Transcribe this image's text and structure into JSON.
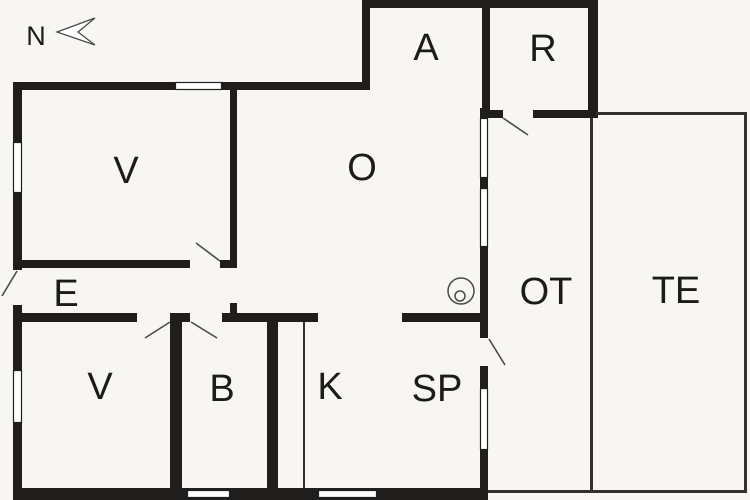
{
  "plan": {
    "width": 750,
    "height": 500,
    "background": "#f7f6f3",
    "wall_color": "#1f1e1c",
    "thin_wall_color": "#33322f",
    "door_leaf_color": "#4b4a47",
    "window_fill": "#ffffff",
    "window_stroke": "#1f1e1c",
    "label_color": "#1c1b19",
    "walls": [
      [
        13,
        82,
        9,
        60
      ],
      [
        13,
        193,
        9,
        77
      ],
      [
        13,
        305,
        9,
        65
      ],
      [
        13,
        423,
        9,
        77
      ],
      [
        13,
        82,
        162,
        8
      ],
      [
        222,
        82,
        148,
        8
      ],
      [
        362,
        0,
        8,
        90
      ],
      [
        362,
        0,
        236,
        8
      ],
      [
        588,
        0,
        10,
        118
      ],
      [
        482,
        8,
        8,
        102
      ],
      [
        482,
        110,
        21,
        8
      ],
      [
        533,
        110,
        65,
        8
      ],
      [
        230,
        90,
        7,
        178
      ],
      [
        22,
        260,
        168,
        8
      ],
      [
        220,
        260,
        17,
        8
      ],
      [
        22,
        313,
        115,
        9
      ],
      [
        170,
        313,
        20,
        9
      ],
      [
        222,
        313,
        96,
        9
      ],
      [
        230,
        303,
        7,
        10
      ],
      [
        402,
        313,
        86,
        9
      ],
      [
        170,
        322,
        12,
        166
      ],
      [
        267,
        322,
        11,
        166
      ],
      [
        13,
        488,
        475,
        12
      ],
      [
        480,
        108,
        8,
        10
      ],
      [
        480,
        178,
        8,
        10
      ],
      [
        480,
        247,
        8,
        91
      ],
      [
        480,
        366,
        8,
        22
      ],
      [
        480,
        450,
        8,
        50
      ]
    ],
    "thin_walls": [
      [
        590,
        118,
        3,
        375
      ],
      [
        596,
        112,
        150,
        3
      ],
      [
        744,
        112,
        3,
        381
      ],
      [
        593,
        490,
        153,
        3
      ],
      [
        488,
        490,
        102,
        3
      ],
      [
        303,
        322,
        2,
        166
      ]
    ],
    "windows": [
      [
        13,
        142,
        9,
        51
      ],
      [
        13,
        370,
        9,
        53
      ],
      [
        175,
        82,
        47,
        8
      ],
      [
        187,
        490,
        43,
        8
      ],
      [
        318,
        490,
        59,
        8
      ],
      [
        480,
        118,
        8,
        60
      ],
      [
        480,
        188,
        8,
        59
      ],
      [
        480,
        388,
        8,
        62
      ]
    ],
    "door_leaves": [
      {
        "name": "entrance-door-leaf",
        "x1": 17,
        "y1": 271,
        "x2": 2,
        "y2": 296
      },
      {
        "name": "door-leaf-v-upper",
        "x1": 220,
        "y1": 261,
        "x2": 196,
        "y2": 243
      },
      {
        "name": "door-leaf-v-lower",
        "x1": 170,
        "y1": 322,
        "x2": 145,
        "y2": 338
      },
      {
        "name": "door-leaf-b",
        "x1": 191,
        "y1": 322,
        "x2": 217,
        "y2": 338
      },
      {
        "name": "door-leaf-r",
        "x1": 503,
        "y1": 118,
        "x2": 528,
        "y2": 135
      },
      {
        "name": "door-leaf-sp-ot",
        "x1": 489,
        "y1": 339,
        "x2": 505,
        "y2": 365
      }
    ],
    "stove_symbol": {
      "cx": 461,
      "cy": 291,
      "r": 13,
      "inner_cx": 460,
      "inner_cy": 296,
      "inner_r": 5
    },
    "north": {
      "label": "N",
      "label_x": 36,
      "label_y": 45,
      "arrow_points": "57,32 95,18 78,32 95,45"
    }
  },
  "rooms": [
    {
      "id": "room-label-a",
      "name": "A",
      "x": 426,
      "y": 60
    },
    {
      "id": "room-label-r",
      "name": "R",
      "x": 543,
      "y": 61
    },
    {
      "id": "room-label-v-upper",
      "name": "V",
      "x": 126,
      "y": 183
    },
    {
      "id": "room-label-o",
      "name": "O",
      "x": 362,
      "y": 180
    },
    {
      "id": "room-label-e",
      "name": "E",
      "x": 66,
      "y": 306
    },
    {
      "id": "room-label-ot",
      "name": "OT",
      "x": 546,
      "y": 304
    },
    {
      "id": "room-label-te",
      "name": "TE",
      "x": 676,
      "y": 303
    },
    {
      "id": "room-label-v-lower",
      "name": "V",
      "x": 100,
      "y": 399
    },
    {
      "id": "room-label-b",
      "name": "B",
      "x": 222,
      "y": 401
    },
    {
      "id": "room-label-k",
      "name": "K",
      "x": 330,
      "y": 399
    },
    {
      "id": "room-label-sp",
      "name": "SP",
      "x": 437,
      "y": 401
    }
  ]
}
